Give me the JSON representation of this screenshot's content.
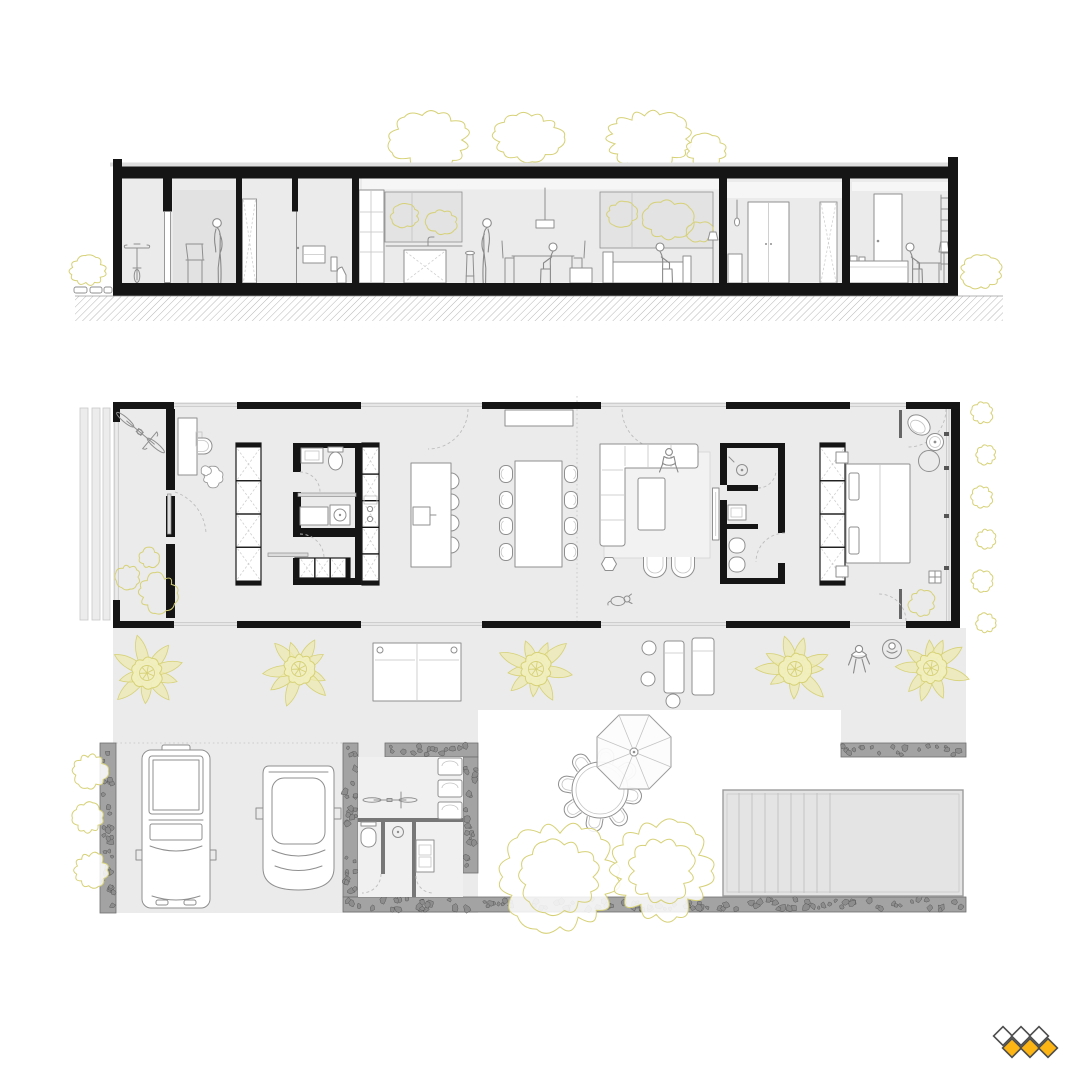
{
  "colors": {
    "floor": "#ebebeb",
    "wall": "#151515",
    "line": "#8f8f8f",
    "lightline": "#c4c4c4",
    "glass": "#e3e3e3",
    "ceiling": "#f6f6f6",
    "backdrop": "#e2e2e2",
    "rug": "#f2f2f2",
    "foliage": "#d6d176",
    "palmfill": "#eeeab0",
    "palmcore": "#f2efbe",
    "pool": "#e4e4e4",
    "poolline": "#9c9c9c",
    "hatch": "#b7b7b7",
    "logoyellow": "#fcb514",
    "logooutline": "#4d4d4d"
  },
  "drawing": {
    "views": [
      {
        "name": "building-cross-section",
        "elements": [
          "roof-slab",
          "floor-slab",
          "ground-hatch",
          "stepping-stones",
          "entry-bike",
          "office-chair",
          "standing-person",
          "sliding-doors",
          "bathroom-toilet",
          "kitchen-counter",
          "kitchen-window-trees",
          "pendant-lamps",
          "dining-table-person",
          "living-window-trees",
          "sofa-person",
          "floor-lamp",
          "hallway-closets",
          "bedroom-bed",
          "desk-person",
          "ladder-shelf",
          "tree-canopies",
          "shrubs"
        ]
      },
      {
        "name": "floor-plan-with-site",
        "indoor": [
          "entry",
          "bike",
          "workspace-desk",
          "storage-wardrobe",
          "bathroom",
          "laundry",
          "tall-kitchen-units",
          "kitchen-island",
          "dining-table",
          "living-sofa",
          "coffee-table",
          "armchairs",
          "tv-console",
          "master-bathroom",
          "wardrobe",
          "bedroom-bed",
          "lounge-chair",
          "plants"
        ],
        "outdoor": [
          "slat-screen",
          "terrace",
          "palm-trees",
          "sun-loungers",
          "people",
          "dog",
          "garage-cars",
          "outdoor-shower-room",
          "storage-lockers",
          "outdoor-bike",
          "stone-walls",
          "round-dining-table",
          "parasol",
          "garden-trees",
          "swimming-pool",
          "shrubs"
        ]
      }
    ],
    "counts": {
      "palm_trees": 5,
      "garden_trees": 2,
      "cars": 2,
      "bikes": 3,
      "indoor_dining_chairs": 8,
      "kitchen_bar_stools": 4,
      "outdoor_dining_chairs": 8,
      "sun_loungers": 4,
      "wardrobe_cells": 8,
      "storage_lockers": 3,
      "people_in_section": 5,
      "people_in_plan": 3,
      "dogs": 1,
      "pool_step_lines": 8
    }
  },
  "logo": {
    "shape": "diamond-grid",
    "top_row": {
      "fill": "white",
      "count": 3
    },
    "bottom_row": {
      "fill": "yellow",
      "count": 3
    }
  }
}
